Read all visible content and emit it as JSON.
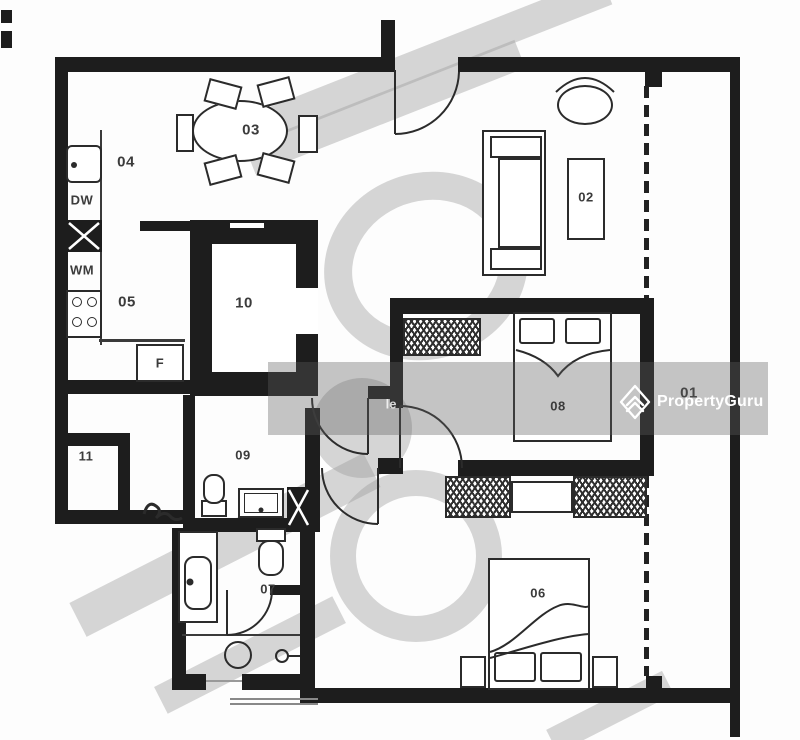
{
  "meta": {
    "type": "apartment-floor-plan"
  },
  "rooms": {
    "balcony": "01",
    "living": "02",
    "dining": "03",
    "kitchen_upper": "04",
    "kitchen_lower": "05",
    "bedroom_lower": "06",
    "bath_lower": "07",
    "bedroom_middle": "08",
    "bath_middle": "09",
    "shelter": "10",
    "store": "11"
  },
  "appliances": {
    "dishwasher": "DW",
    "washer": "WM",
    "fridge": "F"
  },
  "watermark": {
    "brand": "PropertyGuru",
    "partial_text": "le"
  },
  "colors": {
    "wall": "#1d1d1d",
    "label": "#3b3b3b",
    "band_gray": "#5f5f5f",
    "watermark_gray": "#9e9e9e",
    "logo_white": "#ffffff"
  }
}
